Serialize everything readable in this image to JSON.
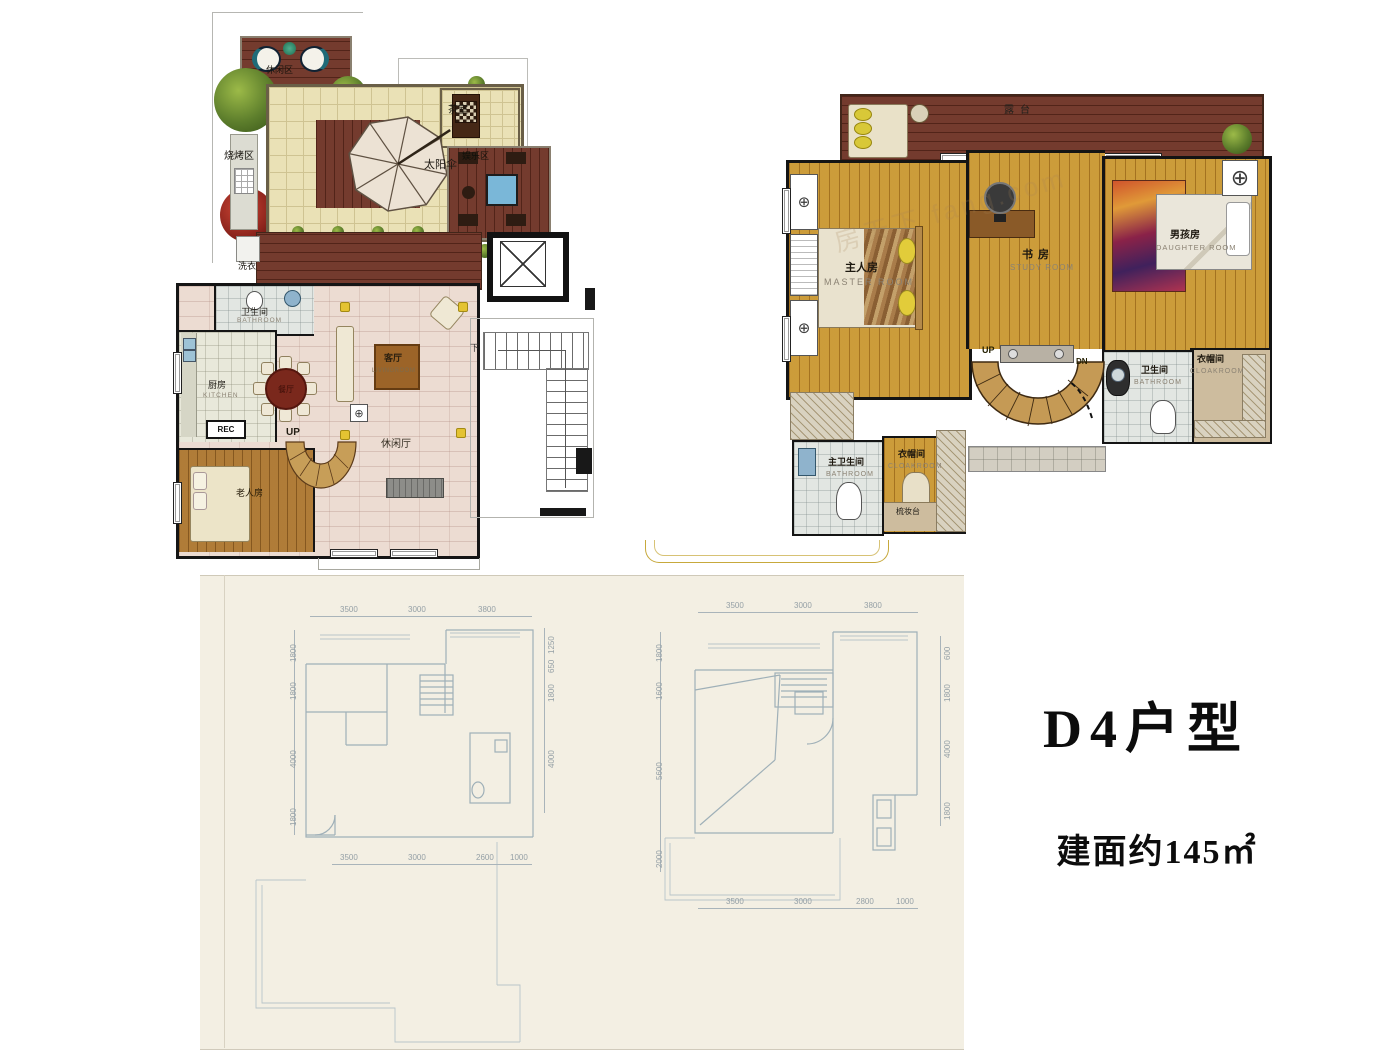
{
  "title": {
    "model": "D4户型",
    "area": "建面约145㎡"
  },
  "watermark": "房天下 fang.com",
  "roof_plan": {
    "labels": {
      "leisure_area": "休闲区",
      "bbq_area": "烧烤区",
      "umbrella": "太阳伞",
      "tea_room": "茶室",
      "entertainment": "娱乐区",
      "laundry": "洗衣"
    }
  },
  "first_floor": {
    "labels": {
      "bathroom_zh": "卫生间",
      "bathroom_en": "BATHROOM",
      "kitchen_zh": "厨房",
      "kitchen_en": "KITCHEN",
      "rec": "REC",
      "dining": "餐厅",
      "living_zh": "客厅",
      "living_en": "LIVINGROOM",
      "lounge": "休闲厅",
      "elder_room": "老人房",
      "up": "UP",
      "down": "下"
    }
  },
  "second_floor": {
    "labels": {
      "terrace": "露台",
      "master_zh": "主人房",
      "master_en": "MASTER ROOM",
      "study_zh": "书房",
      "study_en": "STUDY ROOM",
      "boy_zh": "男孩房",
      "boy_en": "DAUGHTER ROOM",
      "cloak_right_zh": "衣帽间",
      "cloak_right_en": "CLOAKROOM",
      "bath_right_zh": "卫生间",
      "bath_right_en": "BATHROOM",
      "master_bath_zh": "主卫生间",
      "master_bath_en": "BATHROOM",
      "cloak_left_zh": "衣帽间",
      "cloak_left_en": "CLOAKROOM",
      "dresser": "梳妆台",
      "up": "UP",
      "dn": "DN"
    }
  },
  "blueprints": {
    "left": {
      "top": [
        "3500",
        "3000",
        "3800"
      ],
      "left": [
        "1800",
        "1800",
        "4000",
        "1800"
      ],
      "right": [
        "1250",
        "650",
        "1800",
        "4000"
      ],
      "bottom": [
        "3500",
        "3000",
        "2600",
        "1000"
      ]
    },
    "right": {
      "top": [
        "3500",
        "3000",
        "3800"
      ],
      "left": [
        "1800",
        "1600",
        "5600",
        "2000"
      ],
      "right": [
        "600",
        "1800",
        "4000",
        "1800"
      ],
      "bottom": [
        "3500",
        "3000",
        "2800",
        "1000"
      ]
    }
  }
}
